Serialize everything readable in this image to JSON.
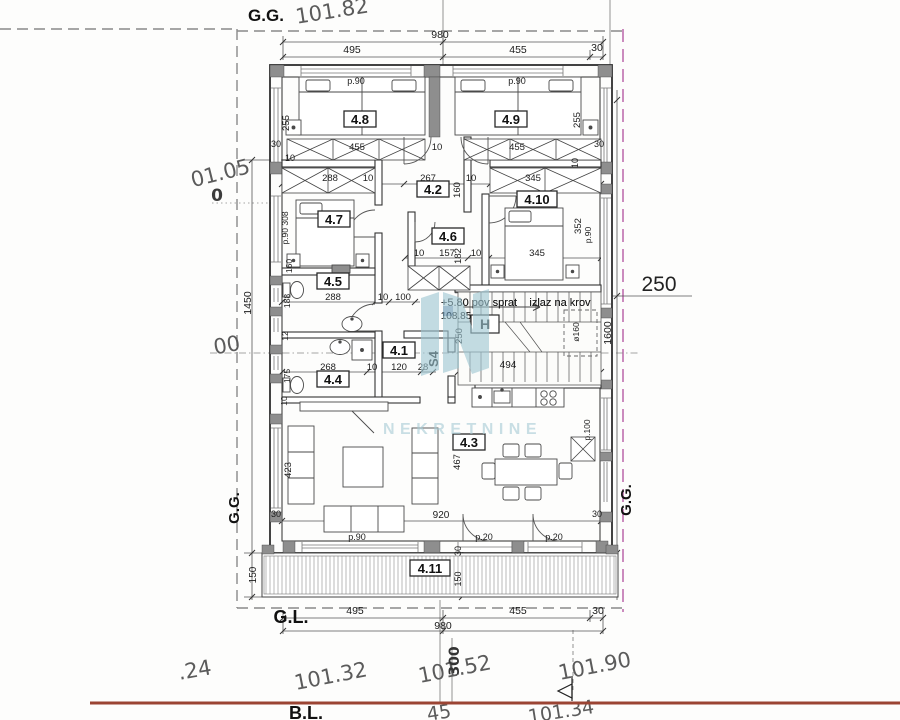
{
  "drawing": {
    "kind": "architectural floor plan (4th / penthouse floor)",
    "colors": {
      "wall_line": "#2d2d2d",
      "dim_line": "#555555",
      "boundary_dash_gray": "#8a8a8a",
      "parcel_dash_magenta": "#bf6fae",
      "ground_line_red": "#9b4433",
      "handwritten": "#5b5b5b",
      "watermark": "#9fc7d3"
    }
  },
  "watermark": {
    "text": "NEKRETNINE",
    "logo": "nekretnine-monogram"
  },
  "rooms": [
    {
      "id": "4.1",
      "x": 399,
      "y": 354
    },
    {
      "id": "4.2",
      "x": 433,
      "y": 193
    },
    {
      "id": "4.3",
      "x": 469,
      "y": 446
    },
    {
      "id": "4.4",
      "x": 333,
      "y": 383
    },
    {
      "id": "4.5",
      "x": 333,
      "y": 285
    },
    {
      "id": "4.6",
      "x": 448,
      "y": 240
    },
    {
      "id": "4.7",
      "x": 334,
      "y": 223
    },
    {
      "id": "4.8",
      "x": 360,
      "y": 123
    },
    {
      "id": "4.9",
      "x": 511,
      "y": 123
    },
    {
      "id": "4.10",
      "x": 537,
      "y": 203
    },
    {
      "id": "4.11",
      "x": 430,
      "y": 572
    }
  ],
  "stairwell": {
    "level_note": "+5.80 pov sprat",
    "level_elevation": "108.85",
    "exit_note": "izlaz na krov",
    "hydrant_label": "H",
    "unit_label": "S4",
    "run_dim": "494",
    "shaft_dim": "ø160",
    "width_dim": "250"
  },
  "annotations": [
    {
      "name": "label-gg-top",
      "text": "G.G.",
      "x": 266,
      "y": 21,
      "size": 17,
      "bold": true,
      "color": "#111111"
    },
    {
      "name": "elev-top-101-82",
      "text": "101.82",
      "x": 333,
      "y": 18,
      "rot": -9,
      "size": 21,
      "font": "hand",
      "color": "#5b5b5b"
    },
    {
      "name": "dim-top-980",
      "text": "980",
      "x": 440,
      "y": 38,
      "size": 10.5
    },
    {
      "name": "dim-top-495",
      "text": "495",
      "x": 352,
      "y": 53,
      "size": 10.5
    },
    {
      "name": "dim-top-455",
      "text": "455",
      "x": 518,
      "y": 53,
      "size": 10.5
    },
    {
      "name": "dim-top-30",
      "text": "30",
      "x": 597,
      "y": 51,
      "size": 10.5
    },
    {
      "name": "elev-left-01-05",
      "text": "01.05",
      "x": 222,
      "y": 180,
      "rot": -14,
      "size": 21,
      "font": "hand",
      "color": "#5b5b5b"
    },
    {
      "name": "elev-left-0",
      "text": "0",
      "x": 217,
      "y": 201,
      "size": 17,
      "font": "hand",
      "bold": true,
      "color": "#3c3c3c"
    },
    {
      "name": "dim-left-1450",
      "text": "1450",
      "x": 251,
      "y": 303,
      "rot": -90,
      "size": 10.5
    },
    {
      "name": "elev-left-00",
      "text": "00",
      "x": 228,
      "y": 352,
      "rot": -10,
      "size": 21,
      "font": "hand",
      "color": "#5b5b5b"
    },
    {
      "name": "label-gg-left",
      "text": "G.G.",
      "x": 239,
      "y": 508,
      "rot": -90,
      "size": 15,
      "bold": true,
      "color": "#111111"
    },
    {
      "name": "dim-left-150",
      "text": "150",
      "x": 256,
      "y": 575,
      "rot": -90,
      "size": 10
    },
    {
      "name": "dim-right-250",
      "text": "250",
      "x": 659,
      "y": 291,
      "size": 21,
      "color": "#222222"
    },
    {
      "name": "dim-right-1600",
      "text": "1600",
      "x": 611,
      "y": 333,
      "rot": -90,
      "size": 10.5
    },
    {
      "name": "label-gg-right",
      "text": "G.G.",
      "x": 631,
      "y": 500,
      "rot": -90,
      "size": 15,
      "bold": true,
      "color": "#111111"
    },
    {
      "name": "label-gl",
      "text": "G.L.",
      "x": 291,
      "y": 623,
      "size": 18,
      "bold": true,
      "color": "#111111"
    },
    {
      "name": "dim-bot-495",
      "text": "495",
      "x": 355,
      "y": 614,
      "size": 10.5
    },
    {
      "name": "dim-bot-455",
      "text": "455",
      "x": 518,
      "y": 614,
      "size": 10.5
    },
    {
      "name": "dim-bot-30",
      "text": "30",
      "x": 598,
      "y": 614,
      "size": 10.5
    },
    {
      "name": "dim-bot-980",
      "text": "980",
      "x": 443,
      "y": 629,
      "size": 10.5
    },
    {
      "name": "elev-bot-24",
      "text": ".24",
      "x": 196,
      "y": 677,
      "rot": -10,
      "size": 21,
      "font": "hand",
      "color": "#5b5b5b"
    },
    {
      "name": "elev-bot-101-32",
      "text": "101.32",
      "x": 332,
      "y": 683,
      "rot": -11,
      "size": 21,
      "font": "hand",
      "color": "#5b5b5b"
    },
    {
      "name": "elev-bot-101-52",
      "text": "101.52",
      "x": 456,
      "y": 676,
      "rot": -11,
      "size": 21,
      "font": "hand",
      "color": "#5b5b5b"
    },
    {
      "name": "dim-bot-300",
      "text": "300",
      "x": 459,
      "y": 661,
      "rot": -90,
      "size": 14,
      "bold": true,
      "font": "hand",
      "color": "#333333"
    },
    {
      "name": "elev-bot-101-90",
      "text": "101.90",
      "x": 596,
      "y": 673,
      "rot": -11,
      "size": 21,
      "font": "hand",
      "color": "#5b5b5b"
    },
    {
      "name": "label-bl",
      "text": "B.L.",
      "x": 306,
      "y": 719,
      "size": 18,
      "bold": true,
      "color": "#111111"
    },
    {
      "name": "elev-bl-45",
      "text": "45",
      "x": 440,
      "y": 719,
      "rot": -9,
      "size": 19,
      "font": "hand",
      "color": "#5b5b5b"
    },
    {
      "name": "elev-bl-101-34",
      "text": "101.34",
      "x": 562,
      "y": 718,
      "rot": -9,
      "size": 19,
      "font": "hand",
      "color": "#5b5b5b"
    },
    {
      "name": "dim-p90-room48",
      "text": "p.90",
      "x": 356,
      "y": 84,
      "size": 9
    },
    {
      "name": "dim-p90-room49",
      "text": "p.90",
      "x": 517,
      "y": 84,
      "size": 9
    },
    {
      "name": "dim-255-left",
      "text": "255",
      "x": 289,
      "y": 123,
      "rot": -90,
      "size": 9.5
    },
    {
      "name": "dim-255-right",
      "text": "255",
      "x": 580,
      "y": 120,
      "rot": -90,
      "size": 9.5
    },
    {
      "name": "dim-30-topleft",
      "text": "30",
      "x": 276,
      "y": 147,
      "size": 9
    },
    {
      "name": "dim-10-topleft",
      "text": "10",
      "x": 290,
      "y": 161,
      "size": 9
    },
    {
      "name": "dim-455-closet-left",
      "text": "455",
      "x": 357,
      "y": 150,
      "size": 9.5
    },
    {
      "name": "dim-10-center-wall",
      "text": "10",
      "x": 437,
      "y": 150,
      "size": 9.5
    },
    {
      "name": "dim-455-closet-right",
      "text": "455",
      "x": 517,
      "y": 150,
      "size": 9.5
    },
    {
      "name": "dim-30-topright",
      "text": "30",
      "x": 599,
      "y": 147,
      "size": 9
    },
    {
      "name": "dim-10-right-wall",
      "text": "10",
      "x": 578,
      "y": 163,
      "rot": -90,
      "size": 9
    },
    {
      "name": "dim-288-closet",
      "text": "288",
      "x": 330,
      "y": 181,
      "size": 9.5
    },
    {
      "name": "dim-10-a",
      "text": "10",
      "x": 368,
      "y": 181,
      "size": 9.5
    },
    {
      "name": "dim-267-corridor",
      "text": "267",
      "x": 428,
      "y": 181,
      "size": 9.5
    },
    {
      "name": "dim-10-b",
      "text": "10",
      "x": 471,
      "y": 181,
      "size": 9.5
    },
    {
      "name": "dim-345-closet",
      "text": "345",
      "x": 533,
      "y": 181,
      "size": 9.5
    },
    {
      "name": "dim-160-corridor",
      "text": "160",
      "x": 460,
      "y": 190,
      "rot": -90,
      "size": 9.5
    },
    {
      "name": "dim-p90-308",
      "text": "p.90 308",
      "x": 288,
      "y": 228,
      "rot": -90,
      "size": 8.5
    },
    {
      "name": "dim-160-room47",
      "text": "160",
      "x": 292,
      "y": 266,
      "rot": -90,
      "size": 8.5
    },
    {
      "name": "dim-10-46l",
      "text": "10",
      "x": 419,
      "y": 256,
      "size": 9.5
    },
    {
      "name": "dim-157-room46",
      "text": "157",
      "x": 447,
      "y": 256,
      "size": 9.5
    },
    {
      "name": "dim-182-room46",
      "text": "182",
      "x": 461,
      "y": 256,
      "rot": -90,
      "size": 9.5
    },
    {
      "name": "dim-10-46r",
      "text": "10",
      "x": 476,
      "y": 256,
      "size": 9.5
    },
    {
      "name": "dim-345-room410",
      "text": "345",
      "x": 537,
      "y": 256,
      "size": 9.5
    },
    {
      "name": "dim-352-room410",
      "text": "352",
      "x": 581,
      "y": 226,
      "rot": -90,
      "size": 9.5
    },
    {
      "name": "dim-p90-room410",
      "text": "p.90",
      "x": 591,
      "y": 235,
      "rot": -90,
      "size": 8.5
    },
    {
      "name": "dim-288-room45",
      "text": "288",
      "x": 333,
      "y": 300,
      "size": 9.5
    },
    {
      "name": "dim-10-45",
      "text": "10",
      "x": 383,
      "y": 300,
      "size": 9.5
    },
    {
      "name": "dim-100-45",
      "text": "100",
      "x": 403,
      "y": 300,
      "size": 9.5
    },
    {
      "name": "dim-188-left",
      "text": "188",
      "x": 290,
      "y": 301,
      "rot": -90,
      "size": 8.5
    },
    {
      "name": "dim-12-left",
      "text": "12",
      "x": 288,
      "y": 336,
      "rot": -90,
      "size": 8.5
    },
    {
      "name": "dim-175-left",
      "text": "175",
      "x": 290,
      "y": 376,
      "rot": -90,
      "size": 8.5
    },
    {
      "name": "dim-10-left",
      "text": "10",
      "x": 287,
      "y": 401,
      "rot": -90,
      "size": 8.5
    },
    {
      "name": "dim-268-room44",
      "text": "268",
      "x": 328,
      "y": 370,
      "size": 9.5
    },
    {
      "name": "dim-10-41a",
      "text": "10",
      "x": 372,
      "y": 370,
      "size": 9.5
    },
    {
      "name": "dim-120-room41",
      "text": "120",
      "x": 399,
      "y": 370,
      "size": 9.5
    },
    {
      "name": "dim-28-room41",
      "text": "28",
      "x": 423,
      "y": 370,
      "size": 9.5
    },
    {
      "name": "label-s4",
      "text": "S4",
      "x": 438,
      "y": 359,
      "rot": -90,
      "size": 13,
      "bold": true,
      "color": "#111111"
    },
    {
      "name": "dim-250-stair",
      "text": "250",
      "x": 462,
      "y": 336,
      "rot": -90,
      "size": 9.5
    },
    {
      "name": "text-pov-sprat",
      "text": "+5.80 pov sprat",
      "x": 479,
      "y": 306,
      "size": 11
    },
    {
      "name": "text-stair-elev",
      "text": "108.85",
      "x": 456,
      "y": 319,
      "size": 10
    },
    {
      "name": "text-izlaz-na-krov",
      "text": "izlaz na krov",
      "x": 560,
      "y": 306,
      "size": 11
    },
    {
      "name": "dim-494-stair",
      "text": "494",
      "x": 508,
      "y": 368,
      "size": 10
    },
    {
      "name": "dim-o160-shaft",
      "text": "ø160",
      "x": 579,
      "y": 332,
      "rot": -90,
      "size": 8.5
    },
    {
      "name": "dim-423-living",
      "text": "423",
      "x": 291,
      "y": 470,
      "rot": -90,
      "size": 9.5
    },
    {
      "name": "dim-30-bottomleft",
      "text": "30",
      "x": 276,
      "y": 517,
      "size": 9
    },
    {
      "name": "dim-920-living",
      "text": "920",
      "x": 441,
      "y": 518,
      "size": 10
    },
    {
      "name": "dim-467-dining",
      "text": "467",
      "x": 460,
      "y": 462,
      "rot": -90,
      "size": 9.5
    },
    {
      "name": "dim-p100-kitchen",
      "text": "p.100",
      "x": 590,
      "y": 430,
      "rot": -90,
      "size": 8.5
    },
    {
      "name": "dim-30-bottomright",
      "text": "30",
      "x": 597,
      "y": 517,
      "size": 9
    },
    {
      "name": "dim-p90-living",
      "text": "p.90",
      "x": 357,
      "y": 540,
      "size": 9
    },
    {
      "name": "dim-p20-door1",
      "text": "p.20",
      "x": 484,
      "y": 540,
      "size": 9
    },
    {
      "name": "dim-p20-door2",
      "text": "p.20",
      "x": 554,
      "y": 540,
      "size": 9
    },
    {
      "name": "dim-30-terrace",
      "text": "30",
      "x": 461,
      "y": 551,
      "rot": -90,
      "size": 9
    },
    {
      "name": "dim-150-terrace",
      "text": "150",
      "x": 461,
      "y": 579,
      "rot": -90,
      "size": 9
    }
  ]
}
